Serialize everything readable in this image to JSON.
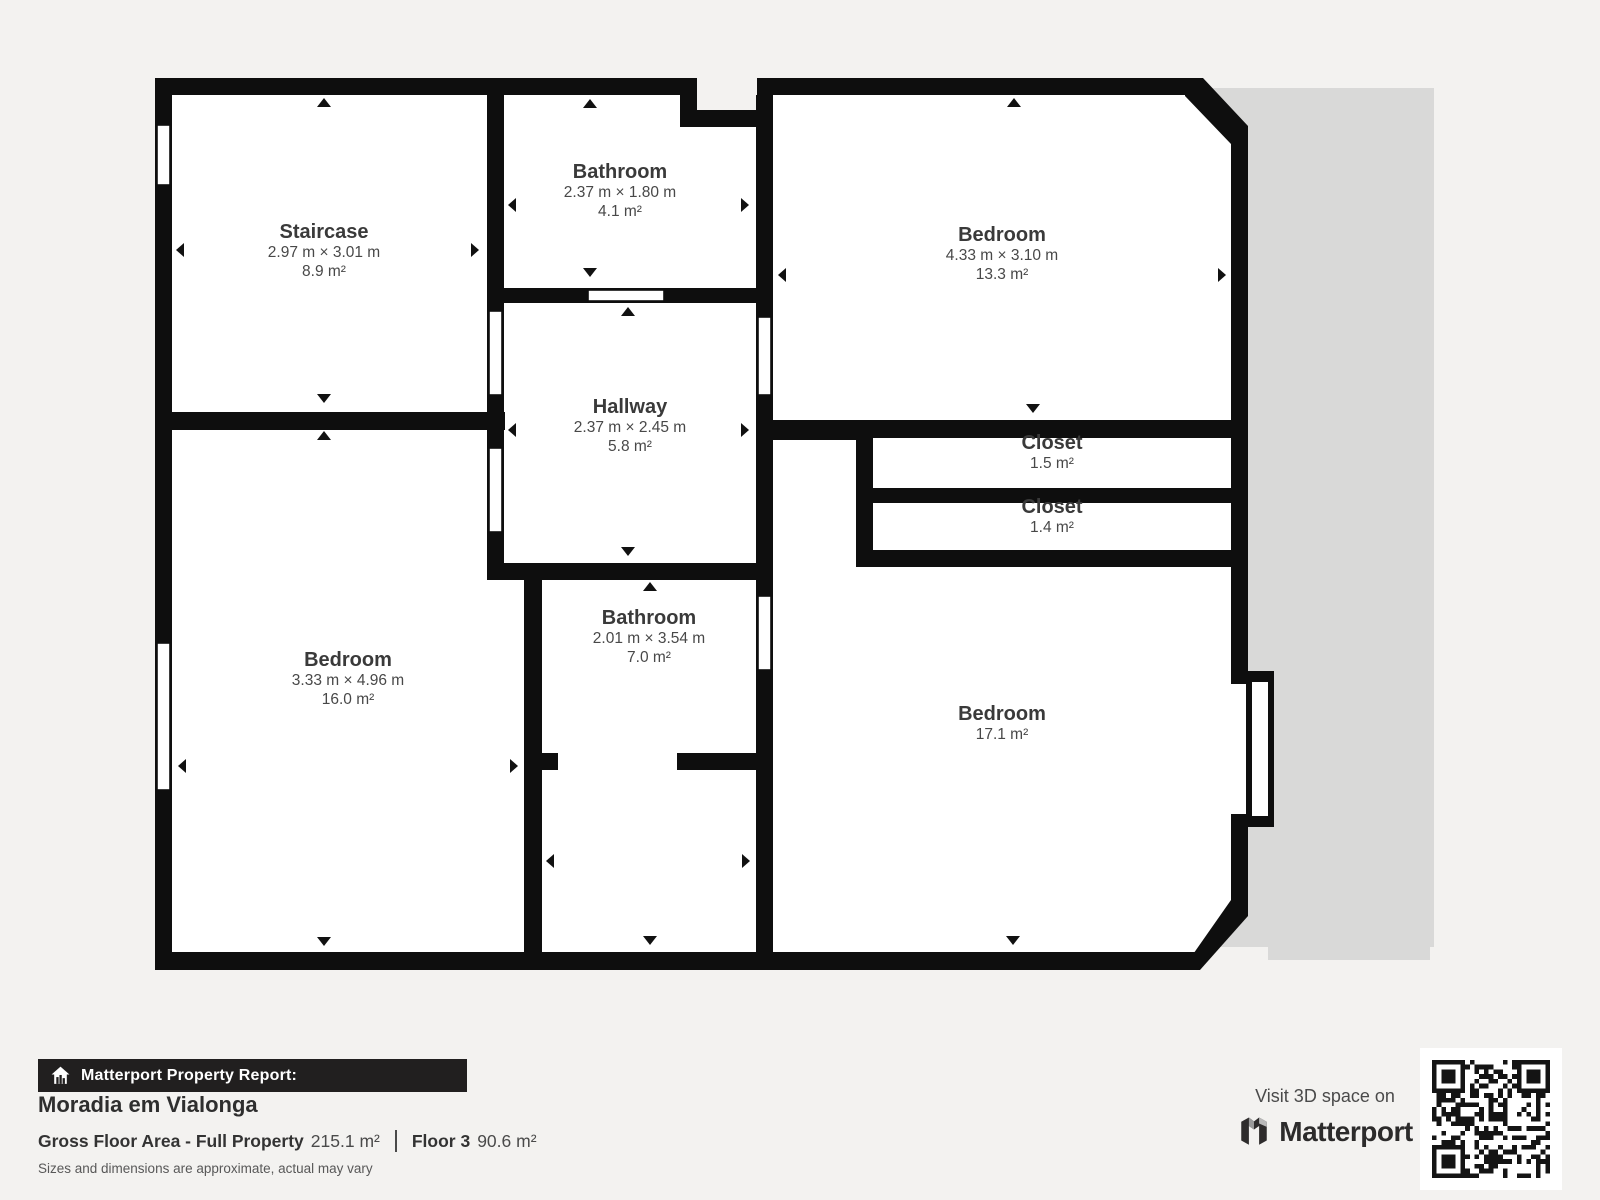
{
  "page": {
    "background": "#f3f2f0"
  },
  "plan": {
    "wall_color": "#0e0e0e",
    "room_fill": "#ffffff",
    "adjacent_area_color": "#d9d9d8",
    "rooms": [
      {
        "id": "staircase",
        "name": "Staircase",
        "dims": "2.97 m × 3.01 m",
        "area": "8.9 m²"
      },
      {
        "id": "bathroom-top",
        "name": "Bathroom",
        "dims": "2.37 m × 1.80 m",
        "area": "4.1 m²"
      },
      {
        "id": "bedroom-top-right",
        "name": "Bedroom",
        "dims": "4.33 m × 3.10 m",
        "area": "13.3 m²"
      },
      {
        "id": "hallway",
        "name": "Hallway",
        "dims": "2.37 m × 2.45 m",
        "area": "5.8 m²"
      },
      {
        "id": "closet-1",
        "name": "Closet",
        "dims": "",
        "area": "1.5 m²"
      },
      {
        "id": "closet-2",
        "name": "Closet",
        "dims": "",
        "area": "1.4 m²"
      },
      {
        "id": "bedroom-left",
        "name": "Bedroom",
        "dims": "3.33 m × 4.96 m",
        "area": "16.0 m²"
      },
      {
        "id": "bathroom-bottom",
        "name": "Bathroom",
        "dims": "2.01 m × 3.54 m",
        "area": "7.0 m²"
      },
      {
        "id": "bedroom-bottom-right",
        "name": "Bedroom",
        "dims": "",
        "area": "17.1 m²"
      }
    ]
  },
  "footer": {
    "report_label": "Matterport Property Report:",
    "property_name": "Moradia em Vialonga",
    "gfa_label": "Gross Floor Area - Full Property",
    "gfa_value": "215.1 m²",
    "floor_label": "Floor 3",
    "floor_value": "90.6 m²",
    "disclaimer": "Sizes and dimensions are approximate, actual may vary",
    "visit_label": "Visit 3D space on",
    "brand": "Matterport"
  }
}
